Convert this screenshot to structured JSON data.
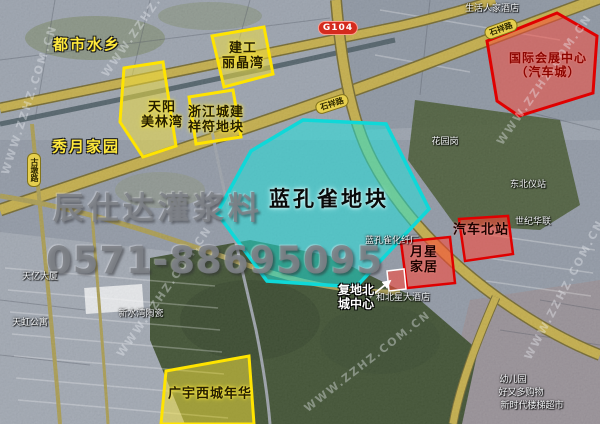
{
  "watermarks": {
    "brand": "辰仕达灌浆料",
    "phone": "0571-88695095",
    "site": "WWW.ZZHZ.COM.CN"
  },
  "road_signs": {
    "g104": "G104",
    "shixiang_road": "石祥路",
    "gudun_road": "古墩路"
  },
  "area_labels": {
    "dushi_shuixiang": "都市水乡",
    "xiuyue_jiayuan": "秀月家园"
  },
  "plots": {
    "jiangong_lijingwan": {
      "line1": "建工",
      "line2": "丽晶湾",
      "color": "#ffee00"
    },
    "tianyang_meilinwan": {
      "line1": "天阳",
      "line2": "美林湾",
      "color": "#ffee00"
    },
    "zhejiang_chengjian": {
      "line1": "浙江城建",
      "line2": "祥符地块",
      "color": "#ffee00"
    },
    "guangyu_xicheng": {
      "label": "广宇西城年华",
      "color": "#ffee00"
    },
    "lankongque": {
      "label": "蓝孔雀地块",
      "color": "#17e8e2"
    },
    "guoji_huizhan": {
      "line1": "国际会展中心",
      "line2": "（汽车城）",
      "color": "#ff3626"
    },
    "qiche_beizhan": {
      "label": "汽车北站",
      "color": "#ff3626"
    },
    "yuexing_jiaju": {
      "line1": "月星",
      "line2": "家居",
      "color": "#ff3626"
    },
    "fudi_beicheng": {
      "line1": "复地北",
      "line2": "城中心"
    }
  },
  "poi_labels": {
    "shenghuo_renjia_hotel": "生活人家酒店",
    "huayuangang": "花园岗",
    "shiji_hualian": "世纪华联",
    "dongbei_yizhan": "东北仪站",
    "hebeixing_hotel": "和北星大酒店",
    "lankongque_factory": "蓝孔雀化纤厂",
    "youeryuan": "幼儿园",
    "haoyouduo": "好又多购物",
    "xinshidai_market": "新时代楼梯超市",
    "tianyi_building": "天亿大厦",
    "tianhong_apartment": "天虹公寓",
    "xinshuiwan_ceramics": "新水湾陶瓷"
  },
  "colors": {
    "plot_yellow": "#ffee00",
    "plot_cyan": "#17e8e2",
    "plot_red": "#ff3626",
    "road_olive": "#c3ac45"
  }
}
